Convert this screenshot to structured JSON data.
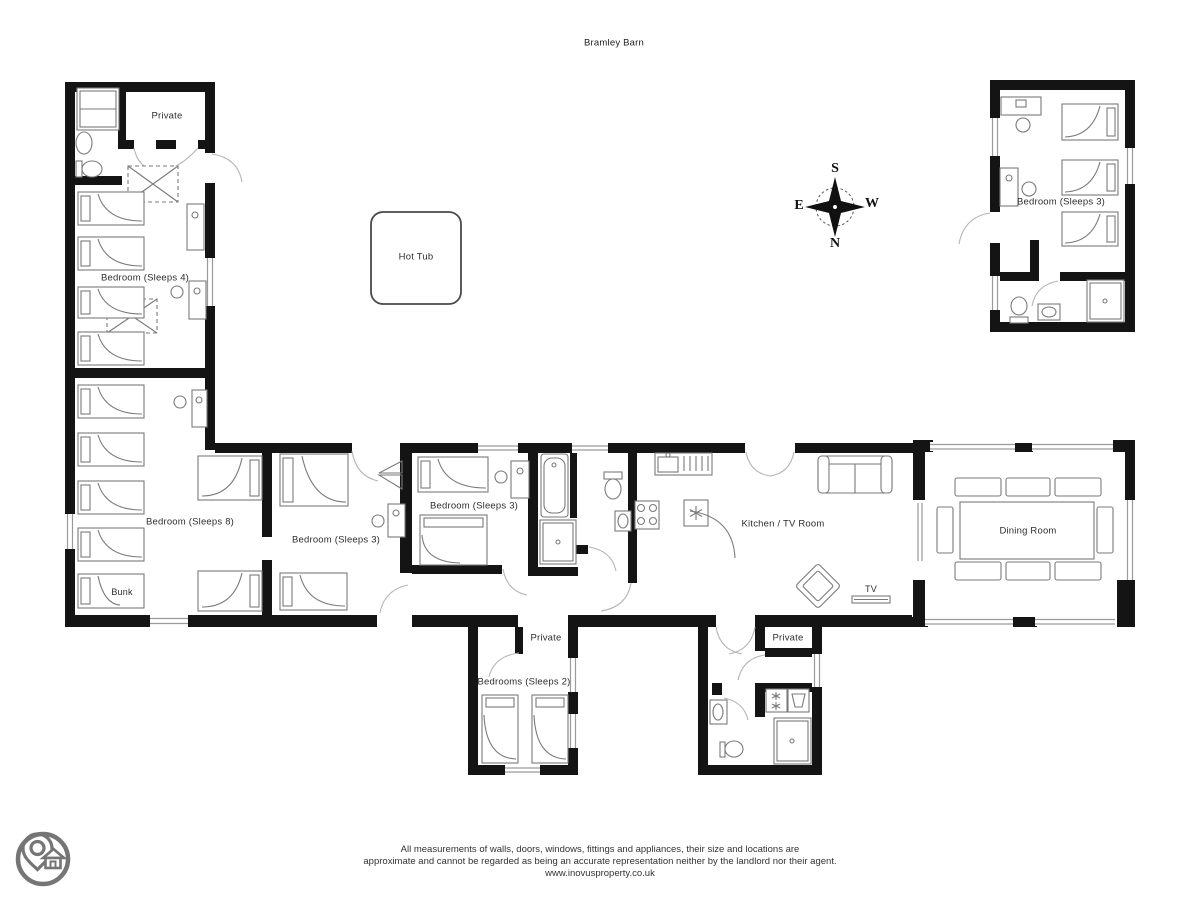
{
  "title": "Bramley Barn",
  "labels": {
    "private_top": "Private",
    "bedroom_sleeps4": "Bedroom (Sleeps 4)",
    "bedroom_sleeps8": "Bedroom (Sleeps 8)",
    "bunk": "Bunk",
    "bedroom_sleeps3_left": "Bedroom (Sleeps 3)",
    "bedroom_sleeps3_mid": "Bedroom (Sleeps 3)",
    "bedroom_sleeps3_annex": "Bedroom (Sleeps 3)",
    "hot_tub": "Hot Tub",
    "kitchen_tv_room": "Kitchen / TV Room",
    "tv": "TV",
    "dining_room": "Dining Room",
    "private_wing1": "Private",
    "bedrooms_sleeps2": "Bedrooms (Sleeps 2)",
    "private_wing2": "Private"
  },
  "compass": {
    "top": "S",
    "bottom": "N",
    "left": "E",
    "right": "W"
  },
  "footer": {
    "line1": "All measurements of walls, doors, windows, fittings and appliances, their size and locations are",
    "line2": "approximate and cannot be regarded as being an accurate representation neither by the landlord nor their agent.",
    "line3": "www.inovusproperty.co.uk"
  },
  "colors": {
    "wall": "#141414",
    "furniture": "#7a7a7a",
    "text": "#2e2e2e",
    "logo": "#757575"
  }
}
